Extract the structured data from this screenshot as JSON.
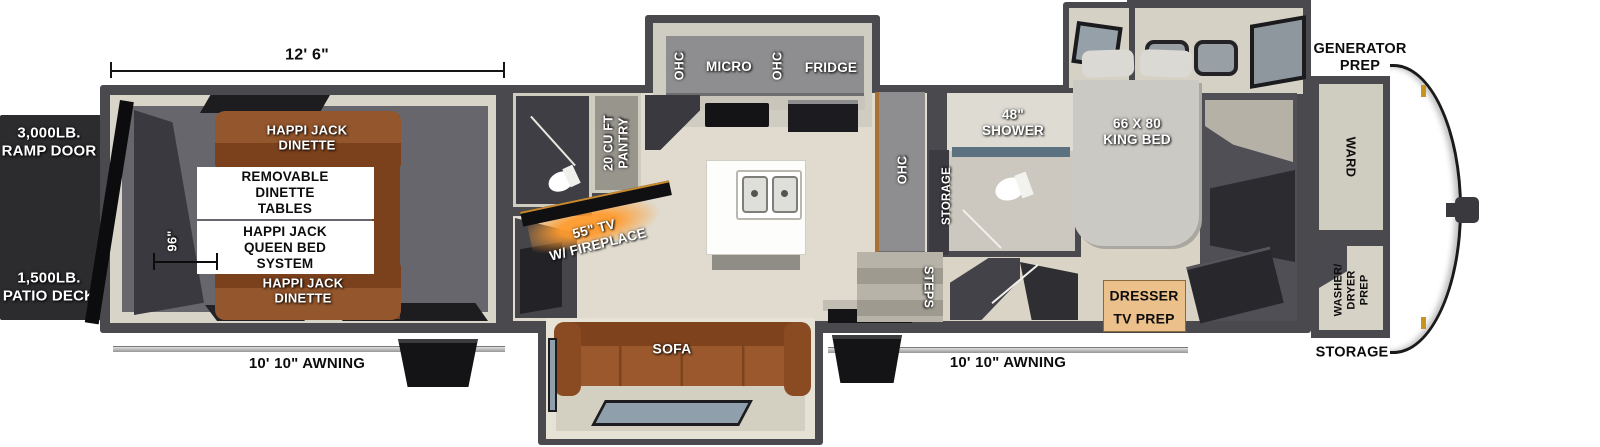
{
  "labels": {
    "dim_width": "12' 6\"",
    "dim_length": "96\"",
    "ramp_door": "3,000LB.\nRAMP DOOR",
    "patio_deck": "1,500LB.\nPATIO DECK",
    "dinette_front": "HAPPI JACK\nDINETTE",
    "removable_tables": "REMOVABLE\nDINETTE\nTABLES",
    "queen_bed": "HAPPI JACK\nQUEEN BED\nSYSTEM",
    "dinette_rear": "HAPPI JACK\nDINETTE",
    "awning_left": "10' 10\" AWNING",
    "pantry": "20 CU FT\nPANTRY",
    "tv_fireplace": "55\" TV\nW/ FIREPLACE",
    "ohc_micro_left": "OHC",
    "micro": "MICRO",
    "ohc_micro_right": "OHC",
    "fridge": "FRIDGE",
    "sofa": "SOFA",
    "ohc_entry": "OHC",
    "shower": "48\"\nSHOWER",
    "bath_storage": "STORAGE",
    "steps": "STEPS",
    "king_bed": "66 X 80\nKING BED",
    "dresser": "DRESSER",
    "tv_prep": "TV PREP",
    "awning_right": "10' 10\" AWNING",
    "generator_prep": "GENERATOR\nPREP",
    "ward": "WARD",
    "washer_dryer": "WASHER/\nDRYER\nPREP",
    "storage_exterior": "STORAGE"
  },
  "colors": {
    "wall": "#4a494d",
    "floor": "#e0dbce",
    "garage_floor": "#67666c",
    "dinette_brown": "#8a4a22",
    "sofa_brown": "#9a5a2e",
    "dresser_tan": "#ecc08a",
    "fireplace_glow": "#f08018",
    "window_glass": "#8fa0ac",
    "ramp_panel": "#2c2b2e"
  }
}
